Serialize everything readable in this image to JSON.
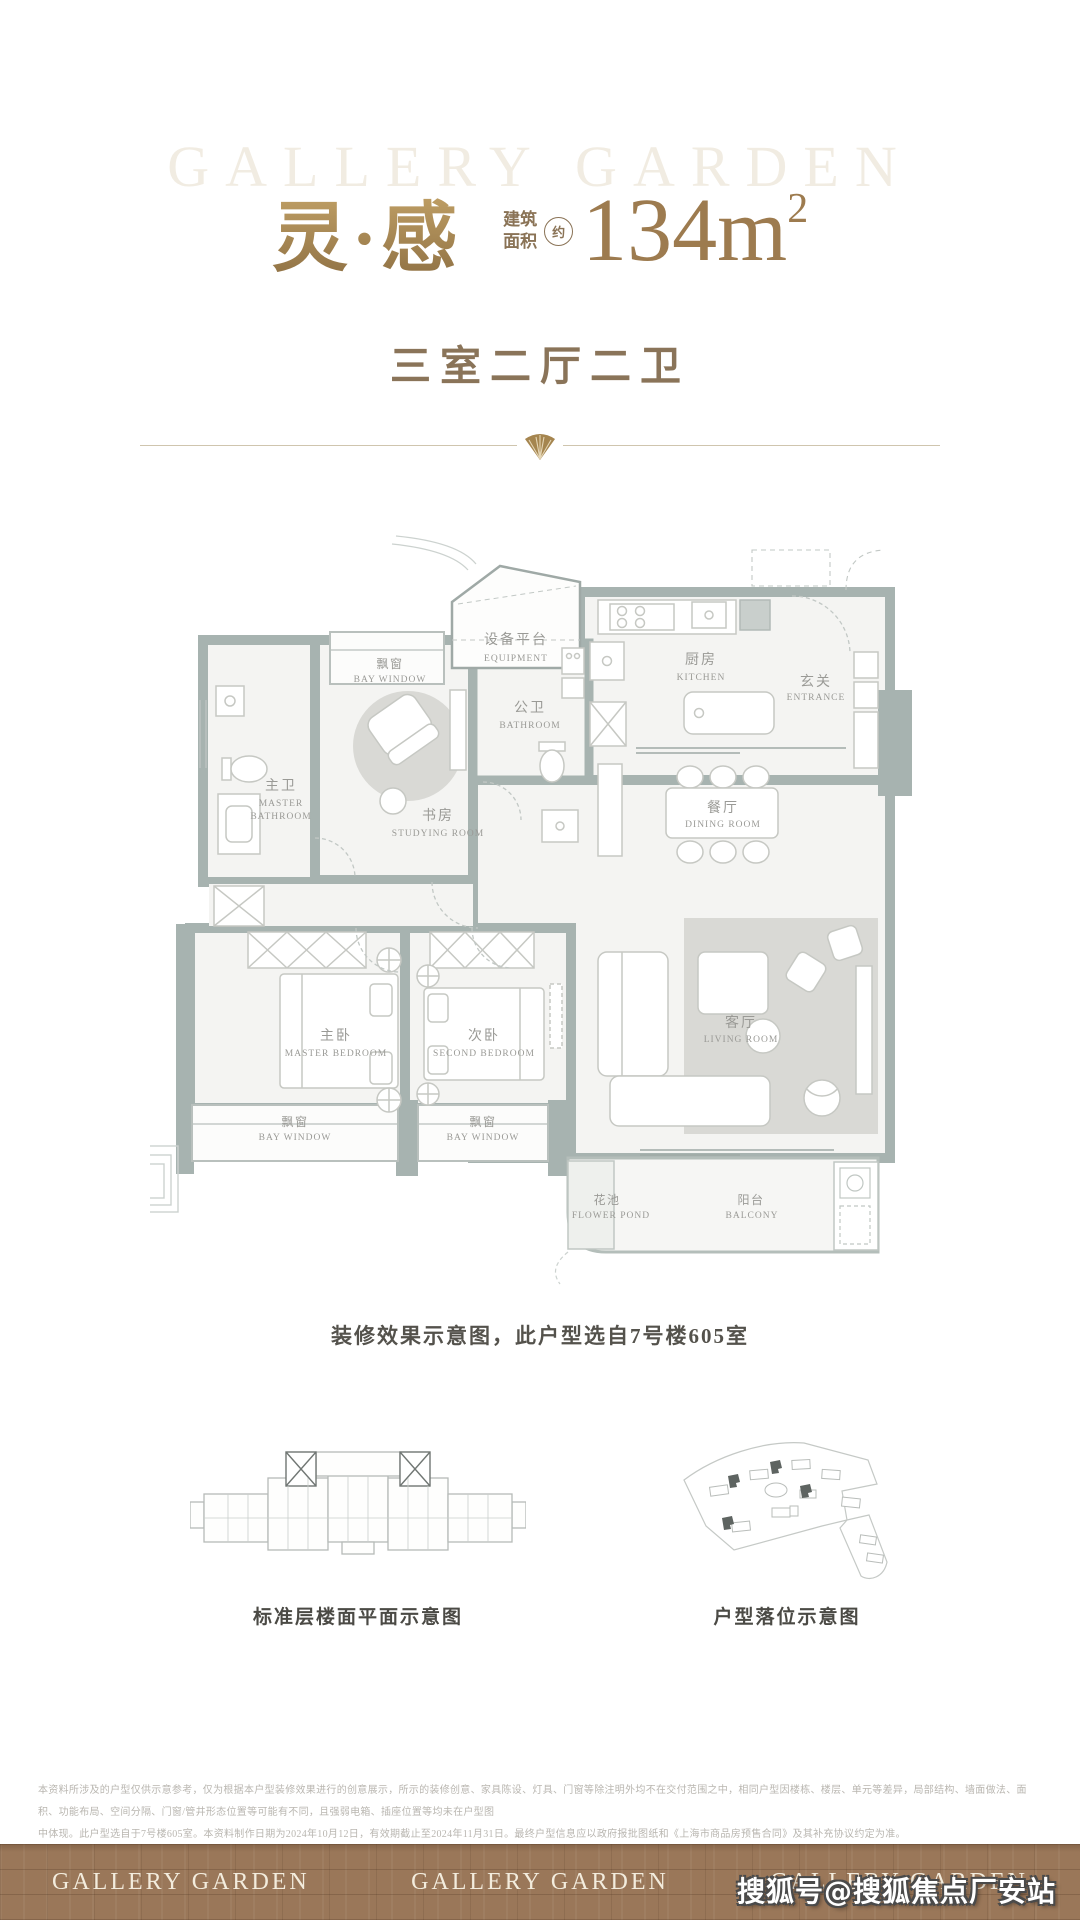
{
  "brand": {
    "watermark": "GALLERY GARDEN"
  },
  "header": {
    "title_cn": "灵·感",
    "area_prefix_line1": "建筑",
    "area_prefix_line2": "面积",
    "area_approx": "约",
    "area_value": "134m",
    "area_sup": "2",
    "subtitle": "三室二厅二卫"
  },
  "floorplan": {
    "rooms": {
      "equipment": {
        "zh": "设备平台",
        "en": "EQUIPMENT"
      },
      "bay_top": {
        "zh": "飘窗",
        "en": "BAY WINDOW"
      },
      "master_bath": {
        "zh": "主卫",
        "en1": "MASTER",
        "en2": "BATHROOM"
      },
      "study": {
        "zh": "书房",
        "en": "STUDYING ROOM"
      },
      "bath2": {
        "zh": "公卫",
        "en": "BATHROOM"
      },
      "kitchen": {
        "zh": "厨房",
        "en": "KITCHEN"
      },
      "entrance": {
        "zh": "玄关",
        "en": "ENTRANCE"
      },
      "dining": {
        "zh": "餐厅",
        "en": "DINING ROOM"
      },
      "master_bed": {
        "zh": "主卧",
        "en": "MASTER BEDROOM"
      },
      "second_bed": {
        "zh": "次卧",
        "en": "SECOND BEDROOM"
      },
      "living": {
        "zh": "客厅",
        "en": "LIVING ROOM"
      },
      "bay_left": {
        "zh": "飘窗",
        "en": "BAY WINDOW"
      },
      "bay_mid": {
        "zh": "飘窗",
        "en": "BAY WINDOW"
      },
      "flower": {
        "zh": "花池",
        "en": "FLOWER POND"
      },
      "balcony": {
        "zh": "阳台",
        "en": "BALCONY"
      }
    }
  },
  "caption": "装修效果示意图，此户型选自7号楼605室",
  "diagrams": {
    "left_caption": "标准层楼面平面示意图",
    "right_caption": "户型落位示意图"
  },
  "disclaimer": {
    "line1": "本资料所涉及的户型仅供示意参考，仅为根据本户型装修效果进行的创意展示，所示的装修创意、家具陈设、灯具、门窗等除注明外均不在交付范围之中，相同户型因楼栋、楼层、单元等差异，局部结构、墙面做法、面积、功能布局、空间分隔、门窗/管井形态位置等可能有不同，且强弱电箱、插座位置等均未在户型图",
    "line2": "中体现。此户型选自于7号楼605室。本资料制作日期为2024年10月12日，有效期截止至2024年11月31日。最终户型信息应以政府报批图纸和《上海市商品房预售合同》及其补充协议约定为准。"
  },
  "footer": {
    "brand": "GALLERY GARDEN"
  },
  "watermark_overlay": "搜狐号@搜狐焦点厂安站",
  "colors": {
    "gold": "#a5854f",
    "brown_text": "#8a7459",
    "wall": "#a7b3b0",
    "room_fill": "#f4f4f2",
    "carpet": "#d9d9d5",
    "footer_bg": "#9a7759",
    "label_gray": "#9a9a96"
  }
}
